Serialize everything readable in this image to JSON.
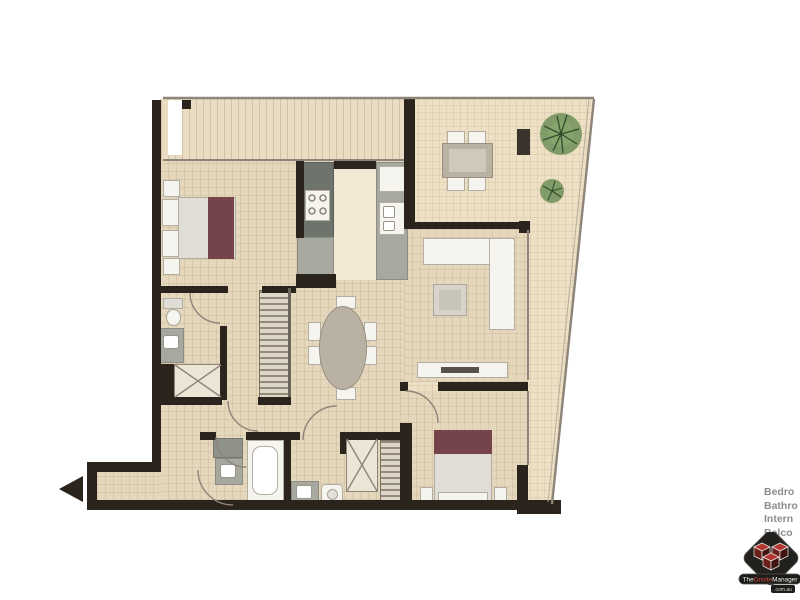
{
  "watermark": {
    "lines": [
      "Bedro",
      "Bathro",
      "Intern",
      "Balco",
      "al"
    ],
    "logo": {
      "the": "The",
      "onsite": "Onsite",
      "manager": "Manager",
      "domain": ".com.au"
    }
  },
  "plan": {
    "colors": {
      "background": "#ffffff",
      "wall": "#2b241d",
      "interior_floor": "#e5d7bc",
      "terrace_floor": "#ede0c4",
      "thin_line": "#8d857a",
      "counter_gray": "#a7a99f",
      "bench_dark": "#6e736c",
      "bed_accent_maroon": "#75444b",
      "furniture_white": "#f5f4ef",
      "plant_green": "#6e8f59",
      "logo_red": "#b23730",
      "logo_dark": "#23211e"
    },
    "rooms": [
      "balcony",
      "terrace",
      "master-bedroom",
      "ensuite",
      "walk-in-robe",
      "kitchen",
      "dining",
      "living",
      "bathroom",
      "laundry",
      "bedroom-2",
      "hall",
      "entry"
    ],
    "icons": {
      "entry_arrow": "left-triangle",
      "plants": "round-shrub",
      "shower": "x-cross",
      "laundry": "x-cross"
    }
  }
}
